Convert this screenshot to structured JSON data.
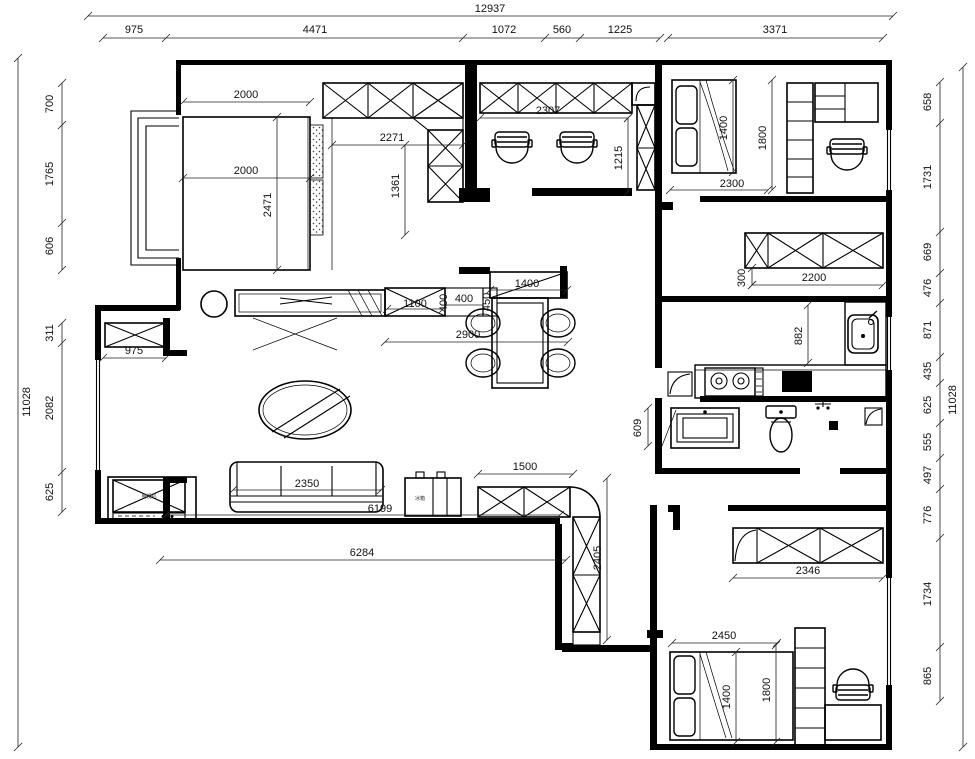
{
  "drawing": {
    "type": "apartment-floor-plan",
    "units": "mm",
    "dims": {
      "top_total": "12937",
      "top": [
        "975",
        "4471",
        "1072",
        "560",
        "1225",
        "3371"
      ],
      "left_total": "11028",
      "left": [
        "700",
        "1765",
        "606",
        "311",
        "2082",
        "625"
      ],
      "right_total": "11028",
      "right": [
        "658",
        "1731",
        "669",
        "476",
        "871",
        "435",
        "625",
        "555",
        "497",
        "776",
        "1734",
        "865"
      ],
      "bed1_width": "2000",
      "bed1_width2": "2000",
      "bed1_length": "2471",
      "cab1_width": "2271",
      "cab1_depth": "1361",
      "study_width": "2307",
      "study_depth": "1215",
      "bed2_width": "1400",
      "bed2_side": "1800",
      "bed2_length": "2300",
      "hall_cab": "2200",
      "hall_cab_offset": "300",
      "kitchen_depth": "882",
      "console": "1100",
      "console_depth": "400",
      "console_gap": "400",
      "console_side": "450",
      "passage_cab": "1400",
      "dining": "2900",
      "entry_cab": "975",
      "bath_niche": "609",
      "sofa": "2350",
      "living_inner": "6199",
      "living_outer": "6284",
      "corner_cab_w": "1500",
      "corner_cab_l": "2405",
      "wardrobe3": "2346",
      "bed3_length": "2450",
      "bed3_width": "1400",
      "bed3_side": "1800"
    },
    "labels": {
      "tv": "电视机",
      "fridge": "冰箱"
    }
  }
}
